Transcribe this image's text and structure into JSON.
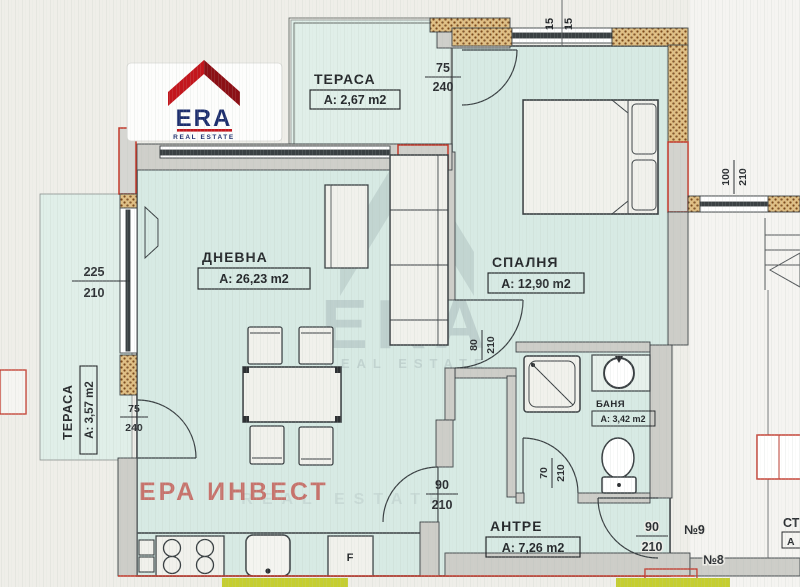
{
  "logo": {
    "brand": "ERA",
    "tagline": "REAL ESTATE"
  },
  "watermark": {
    "company": "ЕРА ИНВЕСТ",
    "brand": "ERA",
    "tagline": "REAL ESTATE"
  },
  "rooms": {
    "terrace_top": {
      "name": "ТЕРАСА",
      "area": "A: 2,67 m2"
    },
    "living": {
      "name": "ДНЕВНА",
      "area": "A: 26,23 m2"
    },
    "bedroom": {
      "name": "СПАЛНЯ",
      "area": "A: 12,90 m2"
    },
    "terrace_left": {
      "name": "ТЕРАСА",
      "area": "A: 3,57 m2"
    },
    "bathroom": {
      "name": "БАНЯ",
      "area": "A: 3,42 m2"
    },
    "hallway": {
      "name": "АНТРЕ",
      "area": "A: 7,26 m2"
    }
  },
  "dimensions": {
    "terrace_door": {
      "num": "75",
      "den": "240"
    },
    "left_window": {
      "num": "225",
      "den": "210"
    },
    "terrace_left_door": {
      "num": "75",
      "den": "240"
    },
    "bedroom_door": {
      "num": "80",
      "den": "210"
    },
    "bath_door": {
      "num": "70",
      "den": "210"
    },
    "hall_door": {
      "num": "90",
      "den": "210"
    },
    "entry_door": {
      "num": "90",
      "den": "210"
    },
    "corridor_window": {
      "num": "100",
      "den": "210"
    },
    "wall_ticks": {
      "t1": "15",
      "t2": "15"
    }
  },
  "annotations": {
    "apartment_9": "№9",
    "apartment_8": "№8",
    "fridge": "F",
    "edge_text_1": "СТ",
    "edge_text_2": "А"
  },
  "colors": {
    "room_fill": "#d7eae4",
    "terrace_fill": "#e0efe9",
    "wall_line": "#3a4043",
    "insulation_dot": "#7b4a1c",
    "red_accent": "#c2382b",
    "highlight_yellow": "#c5ce30",
    "logo_red": "#c3161d",
    "logo_navy": "#1d2e6e",
    "watermark_red": "#c4564f"
  }
}
